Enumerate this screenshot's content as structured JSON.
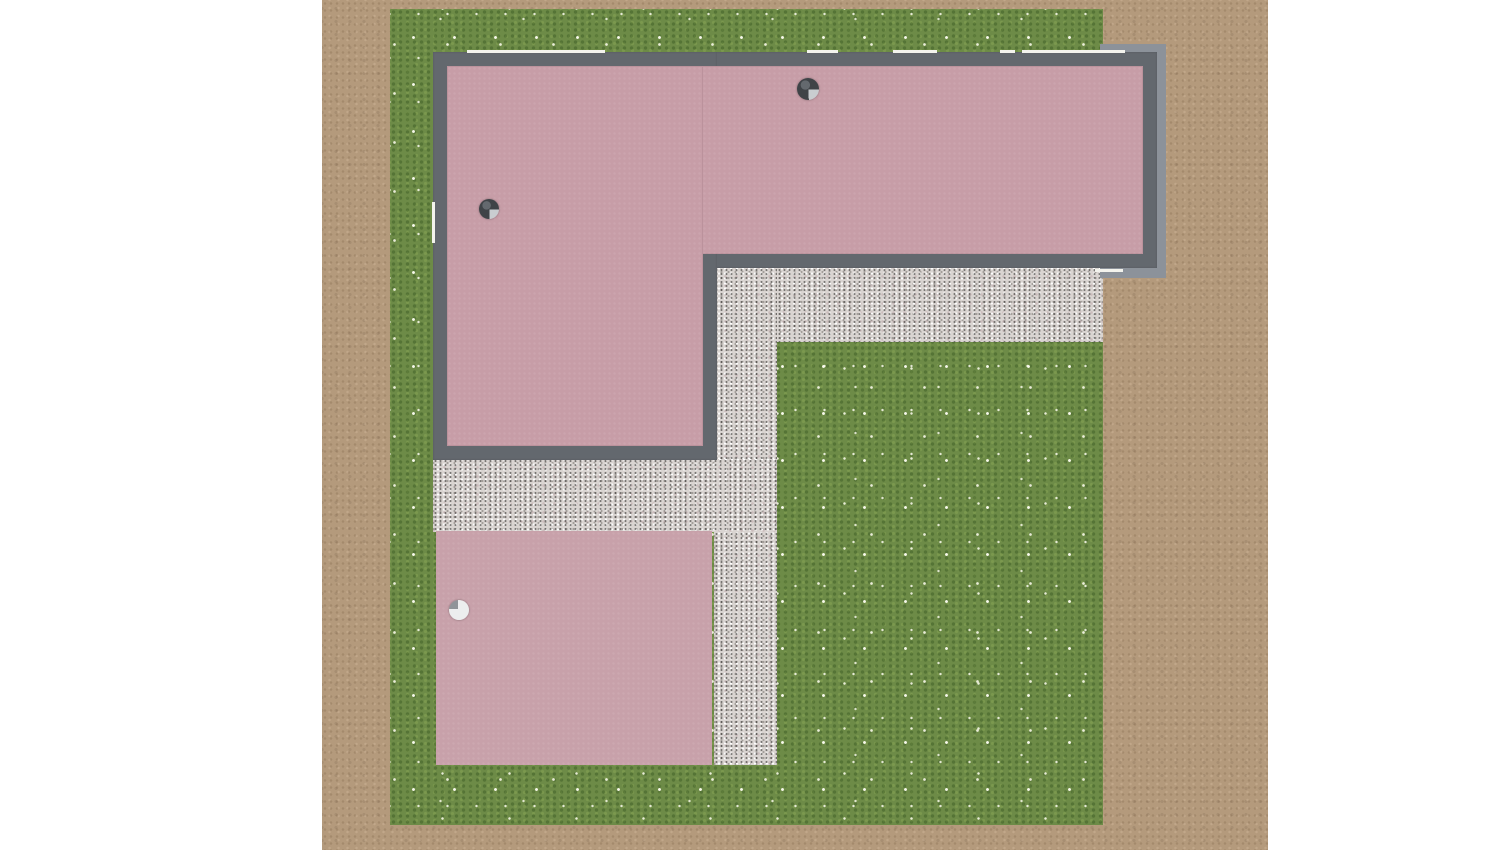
{
  "scene": {
    "canvas": {
      "width": 1500,
      "height": 850,
      "margin_color": "#ffffff"
    },
    "ground": {
      "label": "dirt field",
      "rect": [
        322,
        0,
        946,
        850
      ],
      "color": "#b49a7c"
    },
    "lawn": {
      "label": "flowered lawn",
      "rect": [
        390,
        9,
        713,
        816
      ],
      "color": "#6d8b47",
      "flower_color": "#f7f7e8"
    },
    "gravel": {
      "color": "#d9d4d1",
      "paths": [
        {
          "label": "gravel path under right wing",
          "rect": [
            717,
            268,
            386,
            74
          ]
        },
        {
          "label": "gravel path vertical",
          "rect": [
            714,
            268,
            63,
            497
          ]
        },
        {
          "label": "gravel path under left wing",
          "rect": [
            433,
            459,
            344,
            73
          ]
        }
      ]
    },
    "terrace": {
      "label": "pink terrace slab",
      "rect": [
        436,
        531,
        276,
        234
      ],
      "color": "#c8a1aa"
    },
    "building": {
      "label": "L-shaped building (top view)",
      "wall_color": "#63686e",
      "edge_color": "#8c929a",
      "roof_color": "#c79da7",
      "window_color": "#f3f3ed",
      "edges": [
        {
          "label": "roof edge top right",
          "rect": [
            1100,
            44,
            66,
            10
          ]
        },
        {
          "label": "roof edge right",
          "rect": [
            1155,
            44,
            11,
            234
          ]
        },
        {
          "label": "roof edge bottom right",
          "rect": [
            1100,
            266,
            66,
            12
          ]
        }
      ],
      "walls": [
        {
          "label": "right wing walls",
          "rect": [
            433,
            52,
            724,
            216
          ]
        },
        {
          "label": "left wing walls",
          "rect": [
            433,
            52,
            284,
            408
          ]
        }
      ],
      "roofs": [
        {
          "label": "right wing roof",
          "rect": [
            447,
            66,
            696,
            188
          ]
        },
        {
          "label": "left wing roof",
          "rect": [
            447,
            66,
            256,
            380
          ]
        }
      ],
      "windows": [
        {
          "label": "window top wall 1",
          "rect": [
            467,
            50,
            138,
            3
          ]
        },
        {
          "label": "window top wall 2",
          "rect": [
            807,
            50,
            31,
            3
          ]
        },
        {
          "label": "window top wall 3",
          "rect": [
            893,
            50,
            44,
            3
          ]
        },
        {
          "label": "window top wall 4",
          "rect": [
            1000,
            50,
            15,
            3
          ]
        },
        {
          "label": "window top wall 5",
          "rect": [
            1022,
            50,
            103,
            3
          ]
        },
        {
          "label": "window left wall",
          "rect": [
            432,
            202,
            3,
            41
          ]
        },
        {
          "label": "window bottom of right wing",
          "rect": [
            1095,
            269,
            28,
            3
          ]
        }
      ]
    },
    "chimneys": [
      {
        "label": "chimney on right wing roof",
        "cx": 808,
        "cy": 89,
        "r": 11,
        "variant": "dark"
      },
      {
        "label": "chimney on left wing roof",
        "cx": 489,
        "cy": 209,
        "r": 10,
        "variant": "dark"
      },
      {
        "label": "round vent on terrace",
        "cx": 459,
        "cy": 610,
        "r": 10,
        "variant": "light"
      }
    ],
    "chimney_colors": {
      "dark_base": "#3f4347",
      "dark_highlight": "#c9cdd0",
      "light_base": "#eceeee",
      "light_shade": "#8f9498"
    }
  }
}
